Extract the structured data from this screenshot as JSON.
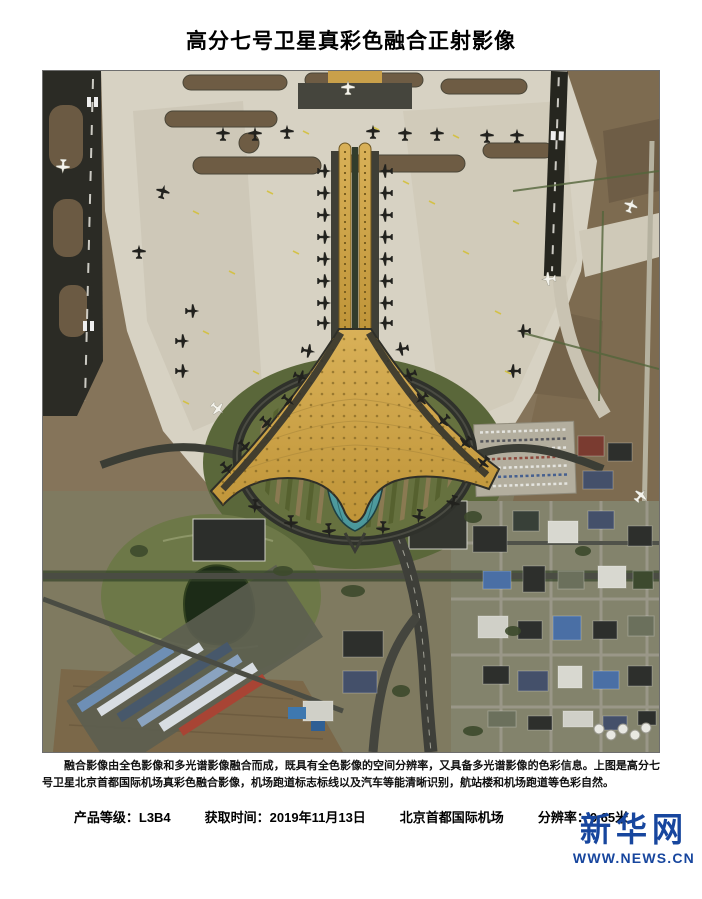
{
  "page": {
    "title": "高分七号卫星真彩色融合正射影像",
    "caption": "融合影像由全色影像和多光谱影像融合而成，既具有全色影像的空间分辨率，又具备多光谱影像的色彩信息。上图是高分七号卫星北京首都国际机场真彩色融合影像，机场跑道标志标线以及汽车等能清晰识别，航站楼和机场跑道等色彩自然。",
    "metadata": {
      "product_grade": "产品等级：L3B4",
      "acquisition_time": "获取时间：2019年11月13日",
      "location": "北京首都国际机场",
      "resolution": "分辨率：0.65米"
    },
    "logo": {
      "name": "新华网",
      "url_text": "WWW.NEWS.CN",
      "color": "#17469e"
    },
    "image": {
      "subject": "北京首都国际机场T3航站楼卫星正射影像",
      "colors": {
        "terminal_gold": "#cfa245",
        "apron_concrete": "#d7d2c3",
        "field_brown": "#85745a",
        "runway_dark": "#26261f",
        "dome_teal": "#4f9fa4",
        "lake_dark": "#1c2b17",
        "park_green": "#66713f",
        "road_dark": "#3e3f39"
      }
    }
  }
}
